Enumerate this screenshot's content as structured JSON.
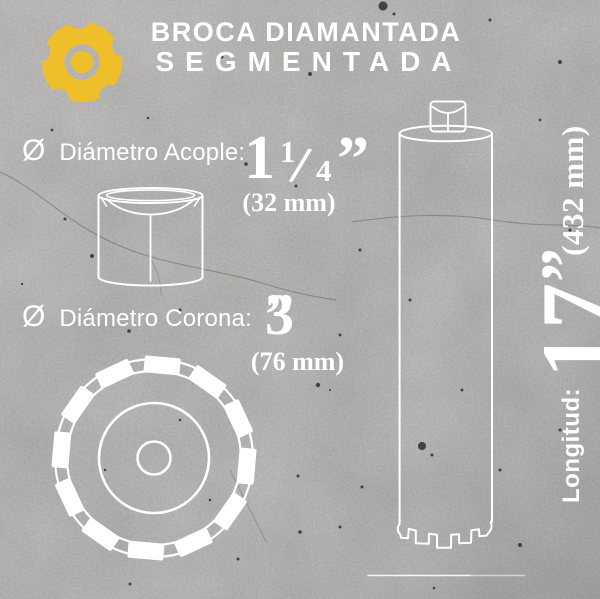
{
  "header": {
    "title_line1": "BROCA DIAMANTADA",
    "title_line2": "SEGMENTADA"
  },
  "specs": {
    "acople": {
      "symbol": "Ø",
      "label": "Diámetro Acople:",
      "value_whole": "1",
      "frac_numerator": "1",
      "frac_slash": "/",
      "frac_denominator": "4",
      "inch_mark": "”",
      "metric": "(32 mm)"
    },
    "corona": {
      "symbol": "Ø",
      "label": "Diámetro Corona:",
      "value": "3",
      "inch_mark": "”",
      "metric": "(76 mm)"
    },
    "longitud": {
      "label": "Longitud:",
      "value": "17",
      "inch_mark": "”",
      "metric": "(432 mm)"
    }
  },
  "icons": {
    "brand_logo": "milling-cutter-gear-logo",
    "adapter_illustration": "acople-adapter-cylinder",
    "crown_illustration": "corona-segmented-crown-top-view",
    "bit_illustration": "segmented-core-drill-bit",
    "ground_line": "baseline-rule"
  },
  "colors": {
    "accent_yellow": "#EFBE2B",
    "text_white": "#FFFFFF",
    "concrete_gray": "#A7A6A3",
    "line_art_white": "#FFFFFF",
    "speckle_dark": "#1F1E1C"
  }
}
